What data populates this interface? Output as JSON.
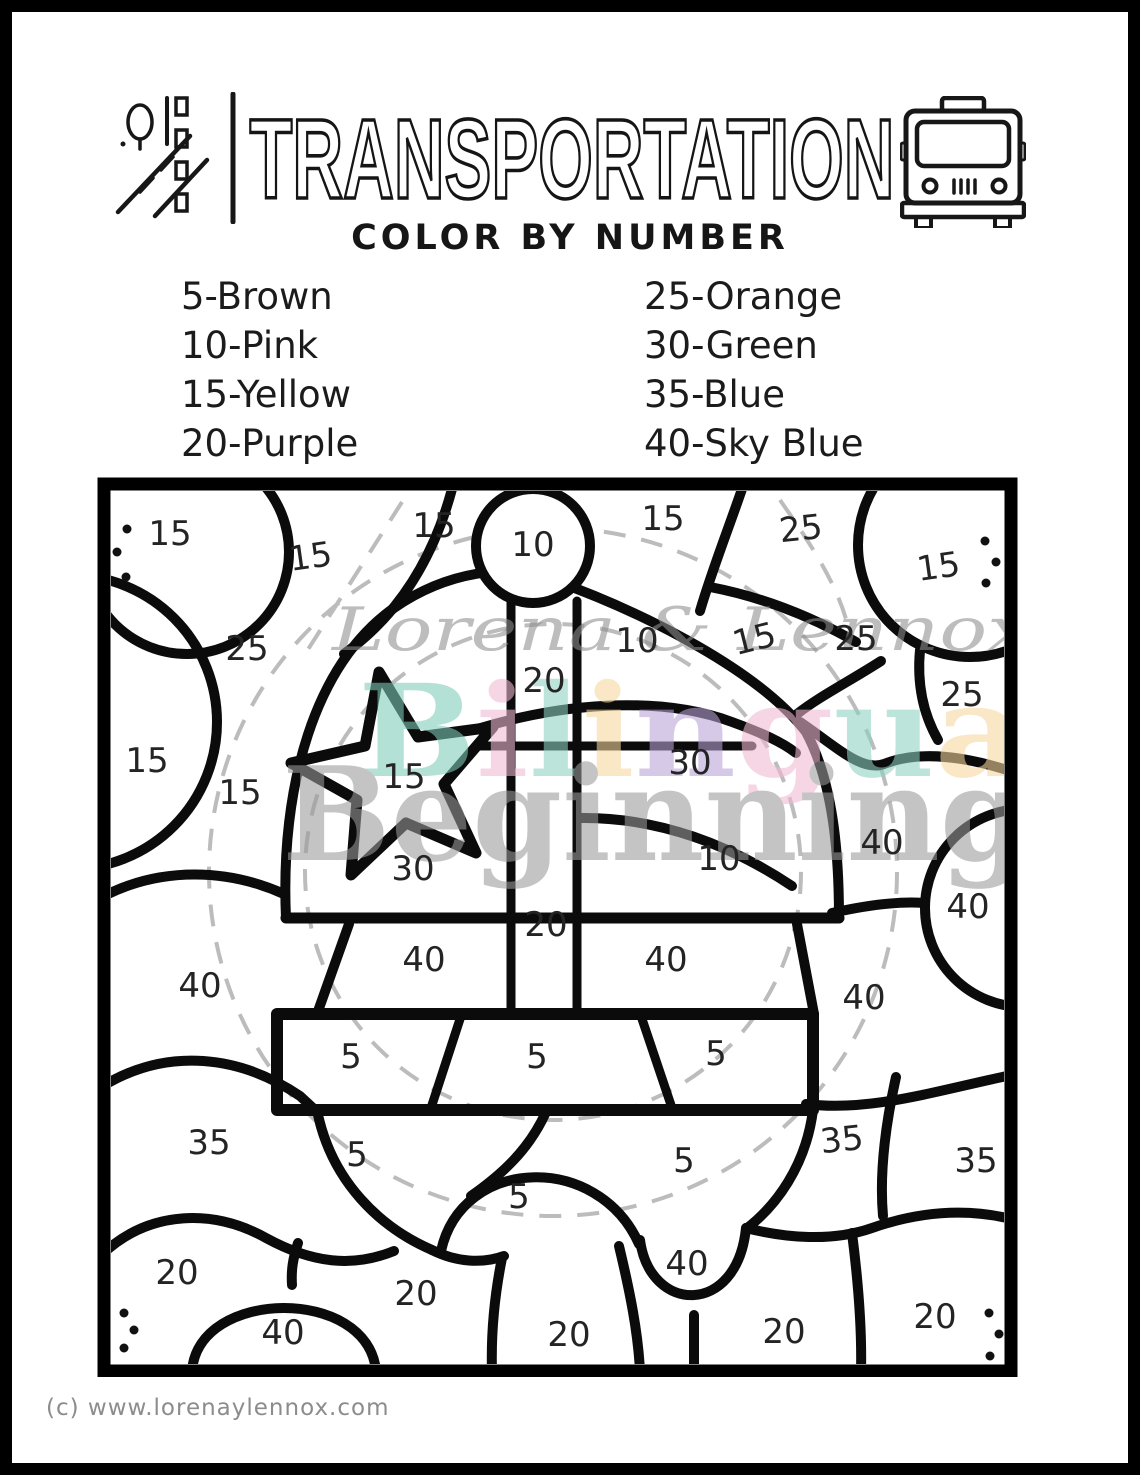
{
  "header": {
    "title": "TRANSPORTATION",
    "subtitle": "COLOR BY NUMBER"
  },
  "legend": {
    "left": [
      {
        "number": "5",
        "color_name": "Brown",
        "label": "5-Brown"
      },
      {
        "number": "10",
        "color_name": "Pink",
        "label": "10-Pink"
      },
      {
        "number": "15",
        "color_name": "Yellow",
        "label": "15-Yellow"
      },
      {
        "number": "20",
        "color_name": "Purple",
        "label": "20-Purple"
      }
    ],
    "right": [
      {
        "number": "25",
        "color_name": "Orange",
        "label": "25-Orange"
      },
      {
        "number": "30",
        "color_name": "Green",
        "label": "30-Green"
      },
      {
        "number": "35",
        "color_name": "Blue",
        "label": "35-Blue"
      },
      {
        "number": "40",
        "color_name": "Sky Blue",
        "label": "40-Sky Blue"
      }
    ]
  },
  "watermark": {
    "line1": "Lorena & Lennox",
    "line3": "Beginnings",
    "line2_letters": [
      {
        "ch": "B",
        "color": "#7fccb9"
      },
      {
        "ch": "i",
        "color": "#f1b9d4"
      },
      {
        "ch": "l",
        "color": "#8fd2c2"
      },
      {
        "ch": "i",
        "color": "#f6d79e"
      },
      {
        "ch": "n",
        "color": "#b9a3d8"
      },
      {
        "ch": "g",
        "color": "#f1b9d4"
      },
      {
        "ch": "u",
        "color": "#8fd2c2"
      },
      {
        "ch": "a",
        "color": "#f6d79e"
      },
      {
        "ch": "l",
        "color": "#8fd2c2"
      }
    ]
  },
  "puzzle": {
    "line_color": "#0b0b0b",
    "region_labels": [
      {
        "n": "15",
        "x": 170,
        "y": 545,
        "r": 0
      },
      {
        "n": "15",
        "x": 312,
        "y": 568,
        "r": -8
      },
      {
        "n": "15",
        "x": 434,
        "y": 537,
        "r": 0
      },
      {
        "n": "10",
        "x": 533,
        "y": 556,
        "r": 0
      },
      {
        "n": "15",
        "x": 663,
        "y": 530,
        "r": 0
      },
      {
        "n": "25",
        "x": 802,
        "y": 540,
        "r": -6
      },
      {
        "n": "15",
        "x": 940,
        "y": 578,
        "r": -8
      },
      {
        "n": "25",
        "x": 247,
        "y": 660,
        "r": 0
      },
      {
        "n": "20",
        "x": 544,
        "y": 692,
        "r": 0
      },
      {
        "n": "10",
        "x": 637,
        "y": 652,
        "r": 0
      },
      {
        "n": "15",
        "x": 757,
        "y": 650,
        "r": -14
      },
      {
        "n": "25",
        "x": 856,
        "y": 650,
        "r": 0
      },
      {
        "n": "25",
        "x": 962,
        "y": 706,
        "r": 0
      },
      {
        "n": "15",
        "x": 147,
        "y": 772,
        "r": 0
      },
      {
        "n": "15",
        "x": 240,
        "y": 804,
        "r": 0
      },
      {
        "n": "15",
        "x": 404,
        "y": 788,
        "r": 0
      },
      {
        "n": "30",
        "x": 690,
        "y": 774,
        "r": 0
      },
      {
        "n": "40",
        "x": 882,
        "y": 854,
        "r": 0
      },
      {
        "n": "30",
        "x": 413,
        "y": 880,
        "r": 0
      },
      {
        "n": "10",
        "x": 719,
        "y": 870,
        "r": 0
      },
      {
        "n": "40",
        "x": 968,
        "y": 918,
        "r": 0
      },
      {
        "n": "20",
        "x": 546,
        "y": 936,
        "r": 0
      },
      {
        "n": "40",
        "x": 200,
        "y": 997,
        "r": 0
      },
      {
        "n": "40",
        "x": 424,
        "y": 971,
        "r": 0
      },
      {
        "n": "40",
        "x": 666,
        "y": 971,
        "r": 0
      },
      {
        "n": "40",
        "x": 864,
        "y": 1009,
        "r": 0
      },
      {
        "n": "5",
        "x": 351,
        "y": 1068,
        "r": 0
      },
      {
        "n": "5",
        "x": 537,
        "y": 1068,
        "r": 0
      },
      {
        "n": "5",
        "x": 716,
        "y": 1065,
        "r": 0
      },
      {
        "n": "35",
        "x": 209,
        "y": 1154,
        "r": 0
      },
      {
        "n": "5",
        "x": 357,
        "y": 1166,
        "r": 0
      },
      {
        "n": "5",
        "x": 519,
        "y": 1208,
        "r": 0
      },
      {
        "n": "5",
        "x": 684,
        "y": 1172,
        "r": 0
      },
      {
        "n": "35",
        "x": 843,
        "y": 1151,
        "r": -6
      },
      {
        "n": "35",
        "x": 976,
        "y": 1172,
        "r": 0
      },
      {
        "n": "20",
        "x": 177,
        "y": 1284,
        "r": 0
      },
      {
        "n": "40",
        "x": 283,
        "y": 1344,
        "r": 0
      },
      {
        "n": "20",
        "x": 416,
        "y": 1305,
        "r": 0
      },
      {
        "n": "20",
        "x": 569,
        "y": 1346,
        "r": 0
      },
      {
        "n": "40",
        "x": 687,
        "y": 1275,
        "r": 0
      },
      {
        "n": "20",
        "x": 784,
        "y": 1343,
        "r": 0
      },
      {
        "n": "20",
        "x": 935,
        "y": 1328,
        "r": 0
      }
    ],
    "corner_dots": [
      {
        "x": 127,
        "y": 529
      },
      {
        "x": 117,
        "y": 552
      },
      {
        "x": 126,
        "y": 577
      },
      {
        "x": 985,
        "y": 541
      },
      {
        "x": 996,
        "y": 562
      },
      {
        "x": 986,
        "y": 583
      },
      {
        "x": 124,
        "y": 1313
      },
      {
        "x": 134,
        "y": 1330
      },
      {
        "x": 124,
        "y": 1348
      },
      {
        "x": 989,
        "y": 1313
      },
      {
        "x": 999,
        "y": 1334
      },
      {
        "x": 990,
        "y": 1356
      }
    ]
  },
  "footer": {
    "credit": "(c) www.lorenaylennox.com"
  }
}
